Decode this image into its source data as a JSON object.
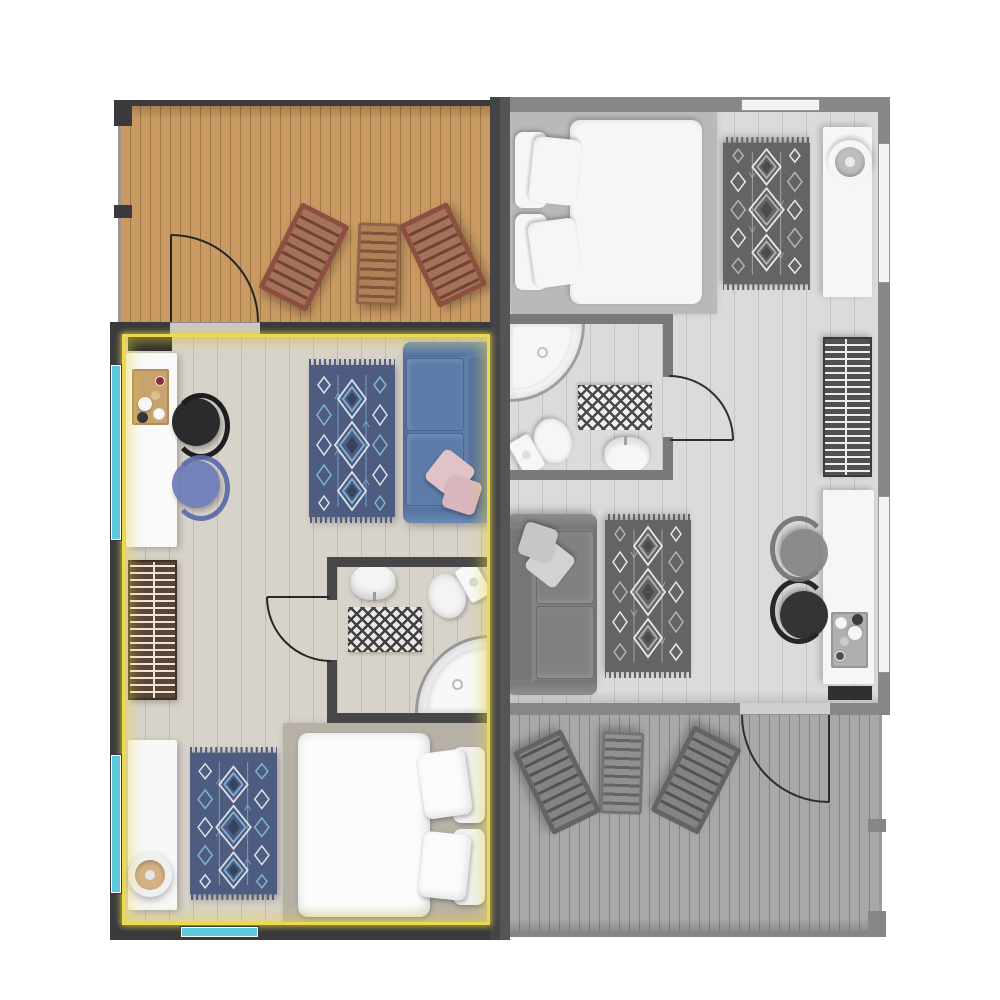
{
  "floor_plan": {
    "type": "apartment-floor-plan",
    "selected_unit": "left",
    "units": {
      "left": {
        "id": "unit-left",
        "state": "selected",
        "grayscale": false,
        "rooms": [
          {
            "name": "terrace-deck",
            "furniture": [
              "lounge-chair",
              "lounge-table",
              "lounge-chair"
            ]
          },
          {
            "name": "living-kitchen",
            "furniture": [
              "kitchen-cabinet",
              "kitchen-counter",
              "serving-tray",
              "bar-chair-black",
              "bar-chair-blue",
              "area-rug",
              "sofa",
              "throw-pillows",
              "radiator"
            ]
          },
          {
            "name": "bathroom",
            "furniture": [
              "washbasin",
              "toilet",
              "bath-mat",
              "corner-shower"
            ]
          },
          {
            "name": "bedroom",
            "furniture": [
              "wardrobe",
              "decor-bowl",
              "area-rug",
              "double-bed"
            ]
          }
        ],
        "window_count": 3,
        "doors": [
          "terrace-door",
          "bathroom-door"
        ]
      },
      "right": {
        "id": "unit-right",
        "state": "unselected",
        "grayscale": true,
        "rooms": [
          {
            "name": "bedroom",
            "furniture": [
              "double-bed",
              "area-rug",
              "wardrobe",
              "decor-bowl"
            ]
          },
          {
            "name": "bathroom",
            "furniture": [
              "corner-shower",
              "toilet",
              "washbasin",
              "bath-mat"
            ]
          },
          {
            "name": "living-kitchen",
            "furniture": [
              "sofa",
              "throw-pillows",
              "area-rug",
              "bar-chair-blue",
              "bar-chair-black",
              "serving-tray",
              "kitchen-counter",
              "radiator"
            ]
          },
          {
            "name": "terrace-deck",
            "furniture": [
              "lounge-chair",
              "lounge-table",
              "lounge-chair"
            ]
          }
        ],
        "window_count": 3,
        "doors": [
          "terrace-door",
          "bathroom-door"
        ]
      }
    }
  },
  "palette": {
    "wall_dark": "#3a3a3c",
    "wall_light": "#7f7f81",
    "divider_dark": "#454547",
    "highlight_yellow": "#ecd94e",
    "window_cyan": "#5ec9da",
    "deck_wood": "#c99a62",
    "floor_light": "#d8d3ca",
    "threshold": "#ccc7bf",
    "rug_base": "#4d5c80",
    "rug_accent": "#7fb6d2",
    "rug_light": "#dfe3e8",
    "rug_dark": "#36435c",
    "sofa_blue": "#5b7aa8",
    "sofa_trim": "#54719e",
    "cushion_blue": "#5d7caa",
    "pillow_pink": "#e0c3c9",
    "pillow_pink2": "#d9b6bd",
    "chair_black": "#2b2b2e",
    "chair_blue": "#6d7cb8",
    "counter_white": "#fafafa",
    "tray_wood": "#c9a36d",
    "radiator_brown": "#5c4534",
    "radiator_slat": "#e9e5db",
    "bath_wall": "#474749",
    "fixture_white": "#f4f4f4",
    "mat_dark": "#3f3f41",
    "mat_light": "#e9e7e3",
    "shower_glass": "#ededef",
    "bed_base": "#b6b0a7",
    "bed_white": "#fcfcfc",
    "pillow_white": "#f1f1f1",
    "wardrobe_white": "#f8f8f8",
    "decor_tan": "#d5b284",
    "lounger_frame": "#8d5040",
    "lounger_slat_a": "#a4715a",
    "lounger_slat_b": "#6f4433",
    "lounger_mid_a": "#b08057",
    "lounger_mid_b": "#7d543c"
  }
}
